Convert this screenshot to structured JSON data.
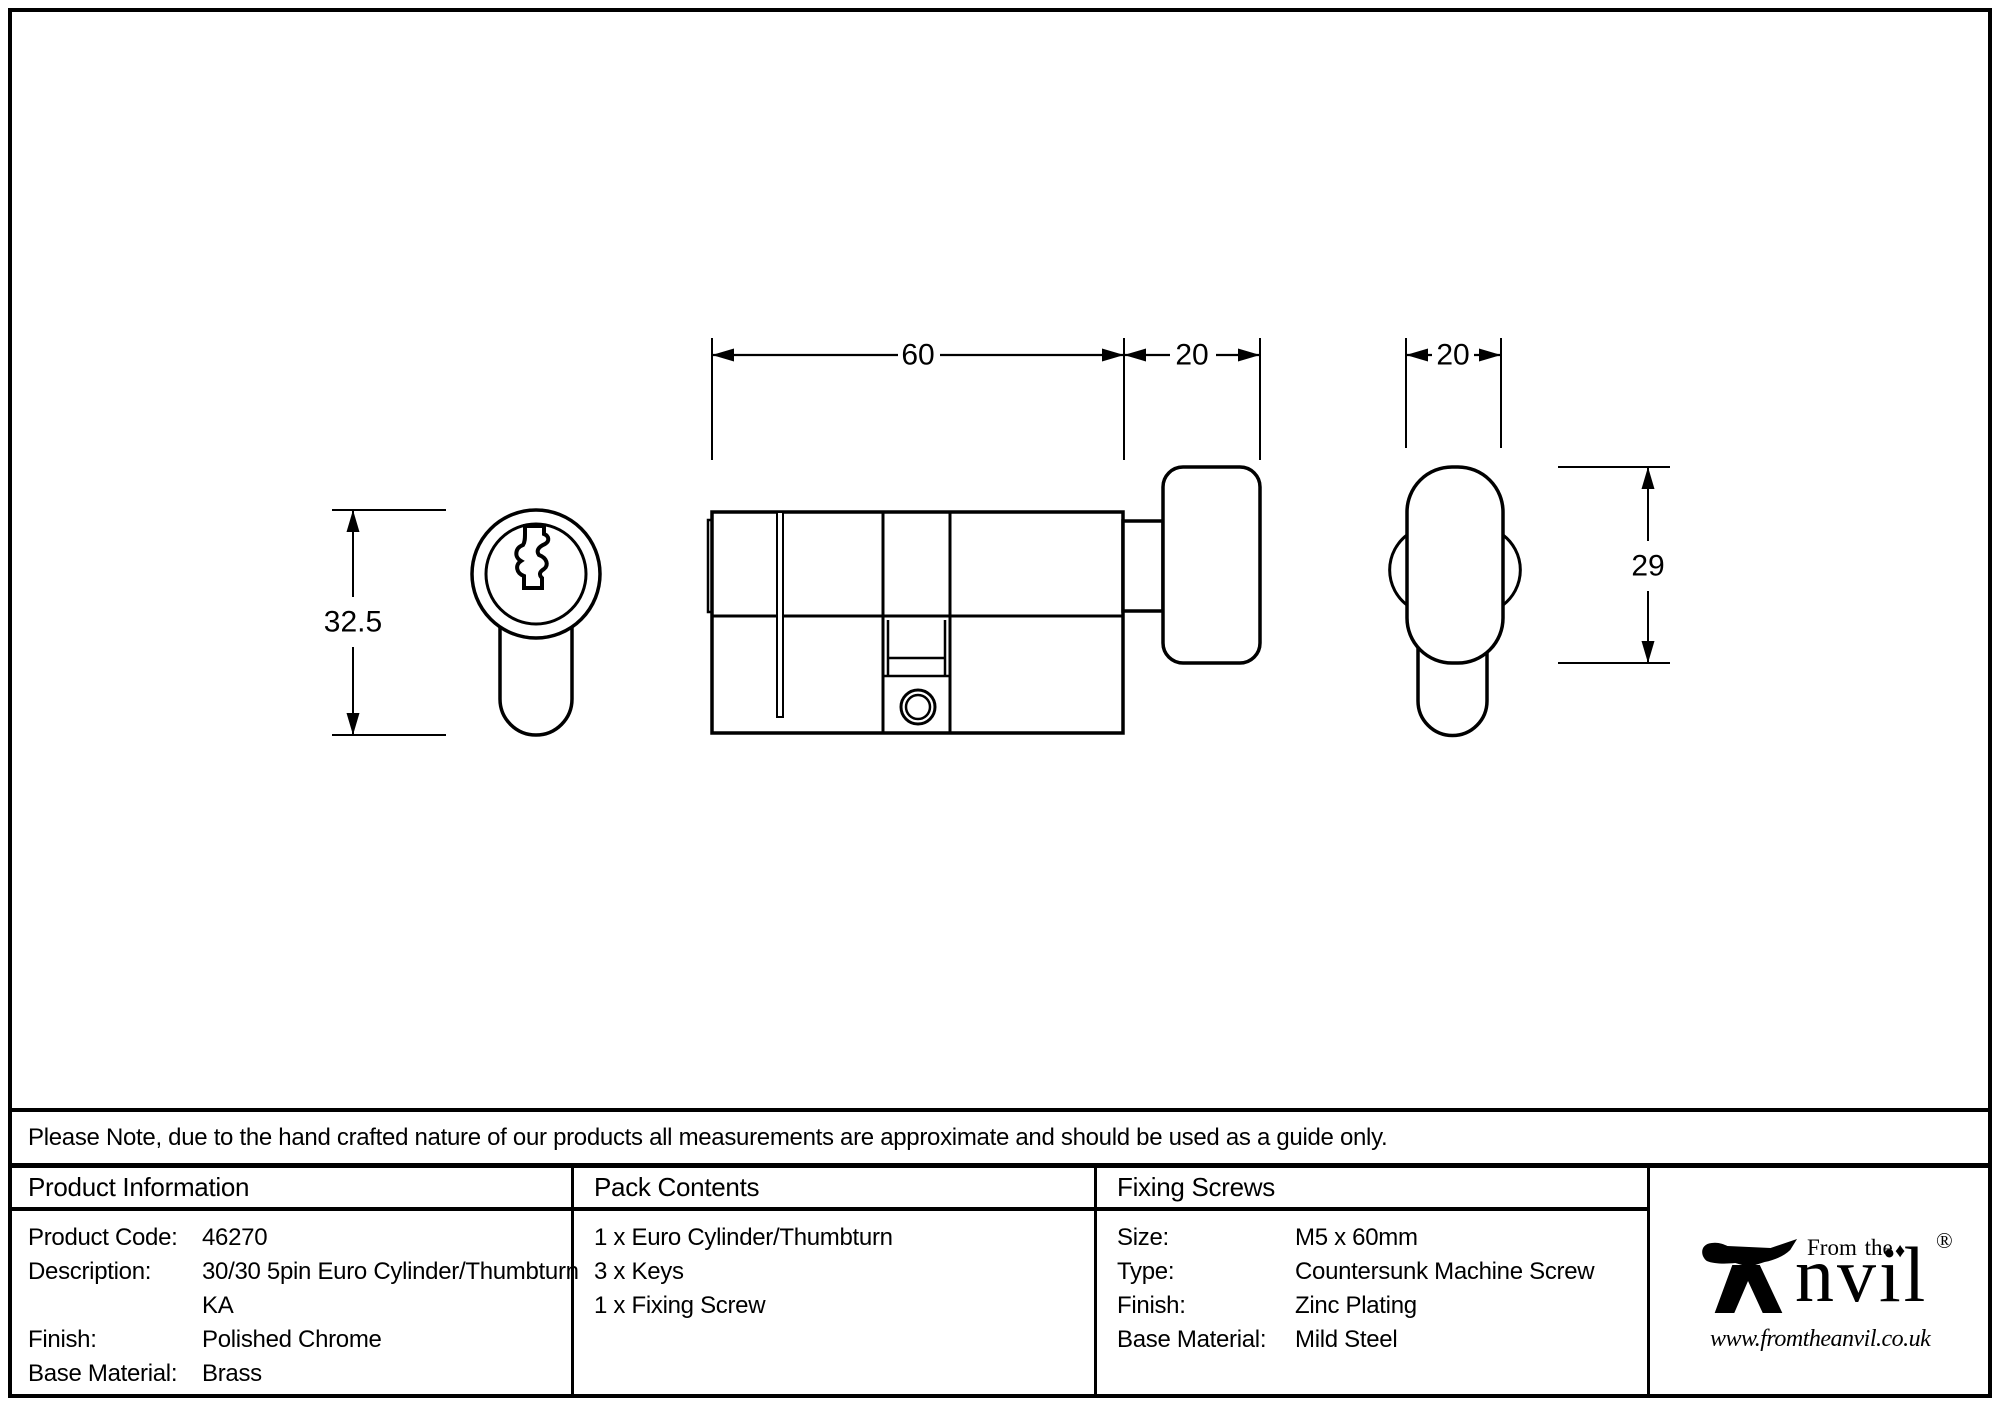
{
  "drawing": {
    "dims": {
      "body_length_mm": "60",
      "knob_length_mm": "20",
      "knob_face_width_mm": "20",
      "cylinder_height_mm": "32.5",
      "knob_height_mm": "29"
    }
  },
  "note": "Please Note, due to the hand crafted nature of our products all measurements are approximate and should be used as a guide only.",
  "product_info": {
    "header": "Product Information",
    "rows": {
      "product_code": {
        "label": "Product Code:",
        "value": "46270"
      },
      "description": {
        "label": "Description:",
        "line1": "30/30 5pin Euro Cylinder/Thumbturn",
        "line2": "KA"
      },
      "finish": {
        "label": "Finish:",
        "value": "Polished Chrome"
      },
      "base_material": {
        "label": "Base Material:",
        "value": "Brass"
      }
    }
  },
  "pack_contents": {
    "header": "Pack Contents",
    "items": [
      "1 x Euro Cylinder/Thumbturn",
      "3 x Keys",
      "1 x Fixing Screw"
    ]
  },
  "fixing_screws": {
    "header": "Fixing Screws",
    "rows": {
      "size": {
        "label": "Size:",
        "value": "M5 x 60mm"
      },
      "type": {
        "label": "Type:",
        "value": "Countersunk Machine Screw"
      },
      "finish": {
        "label": "Finish:",
        "value": "Zinc Plating"
      },
      "base_material": {
        "label": "Base Material:",
        "value": "Mild Steel"
      }
    }
  },
  "logo": {
    "from_the": "From the",
    "diamond": "♦",
    "brand_suffix": "nvil",
    "registered": "®",
    "url": "www.fromtheanvil.co.uk"
  }
}
